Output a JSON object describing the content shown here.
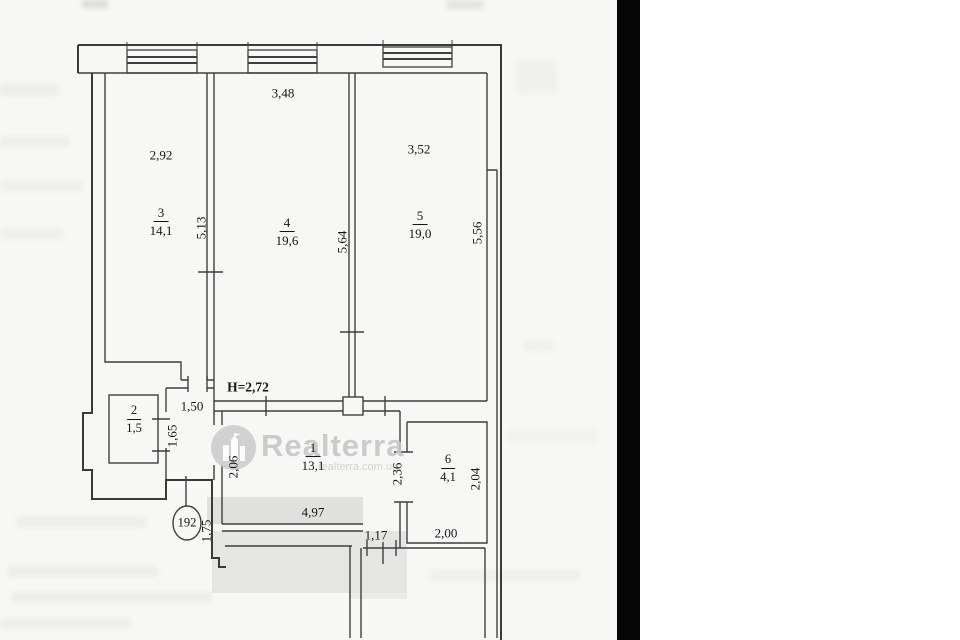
{
  "plan": {
    "apartment_number": "192",
    "ceiling_height": "Н=2,72",
    "rooms": [
      {
        "number": "3",
        "area": "14,1"
      },
      {
        "number": "4",
        "area": "19,6"
      },
      {
        "number": "5",
        "area": "19,0"
      },
      {
        "number": "2",
        "area": "1,5"
      },
      {
        "number": "1",
        "area": "13,1"
      },
      {
        "number": "6",
        "area": "4,1"
      }
    ],
    "dimensions": {
      "room3_width": "2,92",
      "room4_width": "3,48",
      "room5_width": "3,52",
      "room3_depth": "5,13",
      "room4_depth": "5,64",
      "room5_depth": "5,56",
      "hall_opening": "1,50",
      "room2_depth": "1,65",
      "hall_depth": "2,06",
      "corridor_length": "4,97",
      "corridor_door": "1,17",
      "room6_width": "2,00",
      "room6_left_depth": "2,36",
      "room6_right_depth": "2,04",
      "entry_width": "1,75"
    }
  },
  "watermark": {
    "brand": "Realterra",
    "url": "realterra.com.ua"
  },
  "colors": {
    "wall": "#3f3f3f",
    "paper": "#f7f7f5",
    "scan_bar": "#060606",
    "watermark_gray": "#c7c7c7"
  }
}
